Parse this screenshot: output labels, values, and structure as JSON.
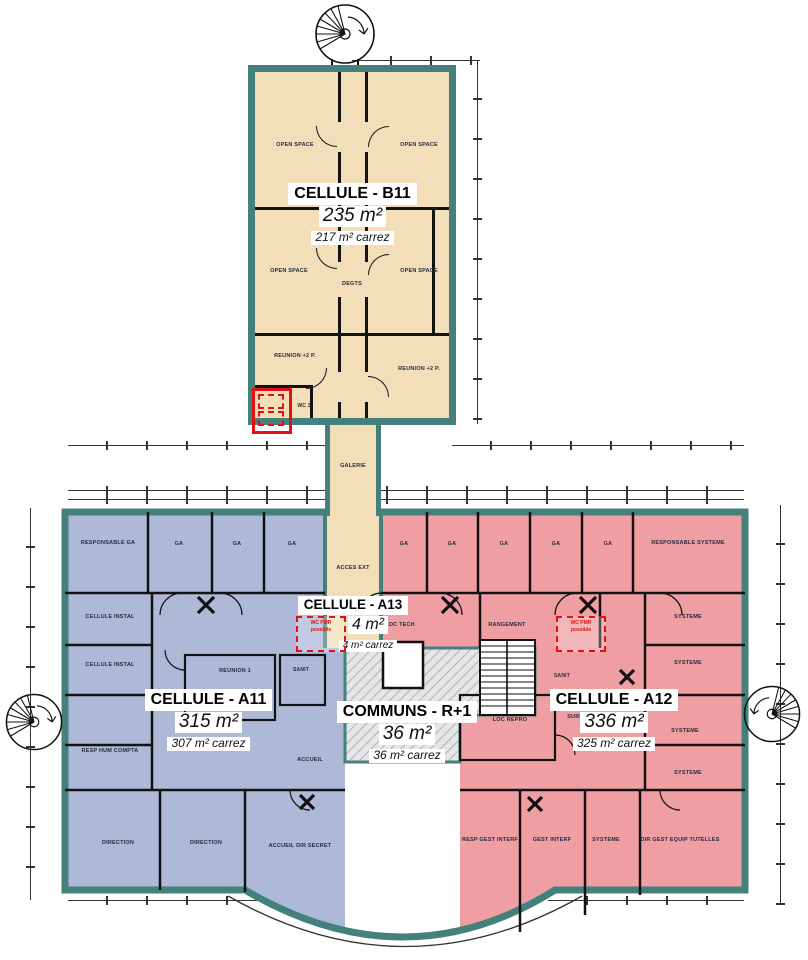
{
  "title_blocks": {
    "b11": {
      "name": "CELLULE - B11",
      "area": "235 m²",
      "carrez": "217 m² carrez"
    },
    "a11": {
      "name": "CELLULE - A11",
      "area": "315 m²",
      "carrez": "307 m² carrez"
    },
    "a12": {
      "name": "CELLULE - A12",
      "area": "336 m²",
      "carrez": "325 m² carrez"
    },
    "a13": {
      "name": "CELLULE - A13",
      "area": "4 m²",
      "carrez": "4 m² carrez"
    },
    "communs": {
      "name": "COMMUNS - R+1",
      "area": "36 m²",
      "carrez": "36 m² carrez"
    }
  },
  "rooms": {
    "open_space": "OPEN SPACE",
    "degts": "DEGTS",
    "reunion_2p": "REUNION +2 P.",
    "wc1": "WC 1",
    "galerie": "GALERIE",
    "acces_ext": "ACCES EXT",
    "responsable_ga": "RESPONSABLE GA",
    "ga": "GA",
    "cellule_instal": "CELLULE INSTAL",
    "reunion_1": "REUNION 1",
    "sanit": "SANIT",
    "resp_hum_compta": "RESP HUM COMPTA",
    "direction": "DIRECTION",
    "accueil": "ACCUEIL",
    "accueil_dir_secret": "ACCUEIL DIR SECRET",
    "loc_tech": "LOC TECH",
    "rangement": "RANGEMENT",
    "loc_repro": "LOC REPRO",
    "surf_dispo": "SURF DISPO",
    "responsable_systeme": "RESPONSABLE SYSTEME",
    "systeme": "SYSTEME",
    "resp_gest_interf": "RESP GEST INTERF",
    "gest_interf": "GEST INTERF",
    "dir_gest_equip_tutelles": "DIR GEST EQUIP TUTELLES"
  },
  "annotations": {
    "wc_pmr_line1": "WC PMR",
    "wc_pmr_line2": "possible"
  },
  "colors": {
    "cell_b11_fill": "#f2dfba",
    "cell_a11_fill": "#adb9d6",
    "cell_a12_fill": "#ef9fa3",
    "communs_fill": "#e3e3e3",
    "wall_teal": "#44807c",
    "highlight_red": "#e01212"
  }
}
